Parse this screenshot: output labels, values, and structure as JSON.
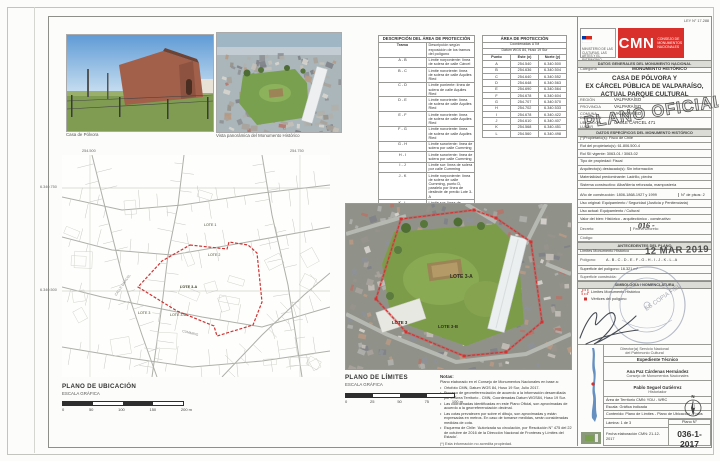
{
  "photos": {
    "caption1": "Casa de Pólvora",
    "caption2": "Vista panorámica del Monumento Histórico"
  },
  "desc_table": {
    "title": "DESCRIPCIÓN DEL ÁREA DE PROTECCIÓN",
    "col1": "Tramo",
    "col2": "Descripción según exposición de los tramos del polígono",
    "rows": [
      [
        "A - B",
        "Límite norponiente: línea de solera de calle Cárcel"
      ],
      [
        "B - C",
        "Límite nororiente: línea de solera de calle Aquiles Ried"
      ],
      [
        "C - D",
        "Límite poniente: línea de solera de calle Aquiles Ried"
      ],
      [
        "D - E",
        "Límite nororiente: línea de solera de calle Aquiles Ried"
      ],
      [
        "E - F",
        "Límite nororiente: línea de solera de calle Aquiles Ried"
      ],
      [
        "F - G",
        "Límite nororiente: línea de solera de calle Aquiles Ried"
      ],
      [
        "G - H",
        "Límite suroriente: línea de solera por calle Cumming"
      ],
      [
        "H - I",
        "Límite suroriente: línea de solera por calle Cumming"
      ],
      [
        "I - J",
        "Límite sur: línea de solera por calle Cumming"
      ],
      [
        "J - K",
        "Límite norponiente: línea de solera de calle Cumming, punto D, paralelo por línea de deslinde de predio Lote 3-A"
      ],
      [
        "K - L",
        "Límite sur: línea de deslinde de predio Lote 3-A"
      ],
      [
        "L - A",
        "Límite surponiente: línea de deslinde de predio Lote 3-A"
      ]
    ]
  },
  "utm_table": {
    "title": "ÁREA DE PROTECCIÓN",
    "subtitle1": "Coordenadas UTM",
    "subtitle2": "Datum WGS 84, Huso 19 Sur",
    "col_punto": "Punto",
    "col_este": "Este (x)",
    "col_norte": "Norte (y)",
    "rows": [
      [
        "A",
        "254.540",
        "6.340.500"
      ],
      [
        "B",
        "254.636",
        "6.340.504"
      ],
      [
        "C",
        "254.640",
        "6.340.552"
      ],
      [
        "D",
        "254.648",
        "6.340.563"
      ],
      [
        "E",
        "254.690",
        "6.340.564"
      ],
      [
        "F",
        "254.678",
        "6.340.604"
      ],
      [
        "G",
        "254.707",
        "6.340.570"
      ],
      [
        "H",
        "254.702",
        "6.340.533"
      ],
      [
        "I",
        "254.678",
        "6.340.422"
      ],
      [
        "J",
        "254.610",
        "6.340.407"
      ],
      [
        "K",
        "254.568",
        "6.340.451"
      ],
      [
        "L",
        "254.560",
        "6.340.498"
      ]
    ]
  },
  "header": {
    "ley": "LEY N° 17.288",
    "ministry": "MINISTERIO DE LAS CULTURAS, LAS ARTES Y EL PATRIMONIO",
    "cmn_acronym": "CMN",
    "cmn_name": "CONSEJO DE MONUMENTOS NACIONALES"
  },
  "title_block": {
    "section_general": "DATOS GENERALES DEL MONUMENTO NACIONAL",
    "categoria_label": "Categoría",
    "categoria_value": "MONUMENTO HISTÓRICO",
    "monument_name_1": "CASA DE PÓLVORA Y",
    "monument_name_2": "EX CÁRCEL PÚBLICA DE VALPARAÍSO,",
    "monument_name_3": "ACTUAL PARQUE CULTURAL",
    "general_rows": [
      {
        "label": "REGIÓN",
        "value": "VALPARAÍSO"
      },
      {
        "label": "PROVINCIA",
        "value": "VALPARAÍSO"
      },
      {
        "label": "COMUNA",
        "value": "VALPARAÍSO"
      },
      {
        "label": "DIRECCIÓN UBICACIÓN LUGAR",
        "value": "CALLE CÁRCEL 471"
      }
    ],
    "section_especificos": "DATOS ESPECÍFICOS DEL MONUMENTO HISTÓRICO",
    "spec_rows1": [
      "(*)Propietario(s): Fisco de Chile",
      "Rut del propietario(s): 61.806.500-4",
      "Rol SII vigente: 3063-01 / 3063-02",
      "Tipo de propiedad: Fiscal",
      "Arquitecto(s) destacado(s): Sin información",
      "Materialidad predominante: Ladrillo, piedra",
      "Sistema constructivo: Albañilería reforzada, mampostería"
    ],
    "anio": "Año de construcción: 1806-1868-1927 y 1999",
    "pisos": "N° de pisos: 2",
    "spec_rows2": [
      "Uso original: Equipamiento / Seguridad (Justicia y Penitenciaria)",
      "Uso actual: Equipamiento / Cultural",
      "Valor del bien: Histórico - arquitectónico - constructivo"
    ],
    "decreto_label": "Decreto:",
    "fecha_decreto_label": "Fecha Decreto:",
    "codigo_label": "Código:",
    "section_antecedentes": "ANTECEDENTES DEL PLANO",
    "limites_label": "Límites Monumento Histórico",
    "poligono_label": "Polígono:",
    "poligono_value": "A - B - C - D - E - F - G - H - I - J - K - L - A",
    "superficie": "Superficie del polígono: 16.321 m²",
    "superficie_construida": "Superficie construida:",
    "simbologia_title": "SIMBOLOGÍA / NOMENCLATURA",
    "legend": [
      "Límites Monumento Histórico",
      "Vértices del polígono"
    ]
  },
  "stamps": {
    "plano_oficial": "PLANO OFICIAL",
    "fecha": "12 MAR 2019",
    "decreto_manuscrito": "016 -",
    "copia": "ES COPIA FIEL"
  },
  "signatures": {
    "approval_1": "Director(a) Servicio Nacional",
    "approval_2": "del Patrimonio Cultural",
    "expediente": "Expediente Técnico",
    "name1": "Ana Paz Cárdenas Hernández",
    "org1": "Consejo de Monumentos Nacionales",
    "name2": "Pablo Seguel Gutiérrez",
    "org2": "Historiador"
  },
  "footer_block": {
    "area": "Área de Territorio CMN: YDU - WRC",
    "escala": "Escala: Gráfica indicada",
    "contenido": "Contenido: Plano de Límites - Plano de Ubicación - Fotos",
    "lamina": "Lámina: 1 de 3",
    "fecha": "Fecha elaboración CMN: 21-12-2017",
    "plano_n_label": "Plano N°",
    "plano_n": "036-1-2017",
    "north": "N"
  },
  "location_plan": {
    "title": "PLANO DE UBICACIÓN",
    "subtitle": "ESCALA GRÁFICA",
    "scale_labels": [
      "0",
      "50",
      "100",
      "150",
      "200 m"
    ],
    "grid_x1": "254.500",
    "grid_x2": "254.750",
    "grid_y1": "6.340.750",
    "grid_y2": "6.340.500",
    "lote1": "LOTE 1",
    "lote2": "LOTE 2",
    "lote3a": "LOTE 3-A",
    "lote3": "LOTE 3",
    "lote3b": "LOTE 3-B",
    "street1": "CALLE CÁRCEL",
    "street2": "CUMMING"
  },
  "limits_plan": {
    "title": "PLANO DE LÍMITES",
    "subtitle": "ESCALA GRÁFICA",
    "scale_labels": [
      "0",
      "25",
      "50",
      "75",
      "100 m"
    ],
    "lote3": "LOTE 3",
    "lote3a": "LOTE 3-A",
    "lote3b": "LOTE 3-B"
  },
  "notes": {
    "title": "Notas:",
    "intro": "Plano elaborado en el Consejo de Monumentos Nacionales en base a:",
    "items": [
      "Ortofoto CMN, Datum WGS 84, Huso 19 Sur, Julio 2017.",
      "Proceso de georreferenciación de acuerdo a la información desarrollada por el Área Territorio - CMN, Coordenadas Datum WGS84, Huso 19 Sur.",
      "Las coordenadas identificadas en este Plano Oficial, son aproximadas de acuerdo a la georreferenciación decimal.",
      "Las cotas prevalecen por sobre el dibujo, son aproximadas y están expresadas en metros. En caso de tomarse medidas, serán consideradas medidas de cota.",
      "Esquema de Chile: 'Autorizada su circulación, por Resolución N° 475 del 22 de octubre de 2016 de la Dirección Nacional de Fronteras y Límites del Estado'."
    ],
    "footnote": "(*) Esta información no acredita propiedad."
  },
  "colors": {
    "cmn_red": "#d9302b",
    "boundary_red": "#cf3333",
    "park_green": "#7d9c4a",
    "stamp_blue": "#7c86a0"
  }
}
